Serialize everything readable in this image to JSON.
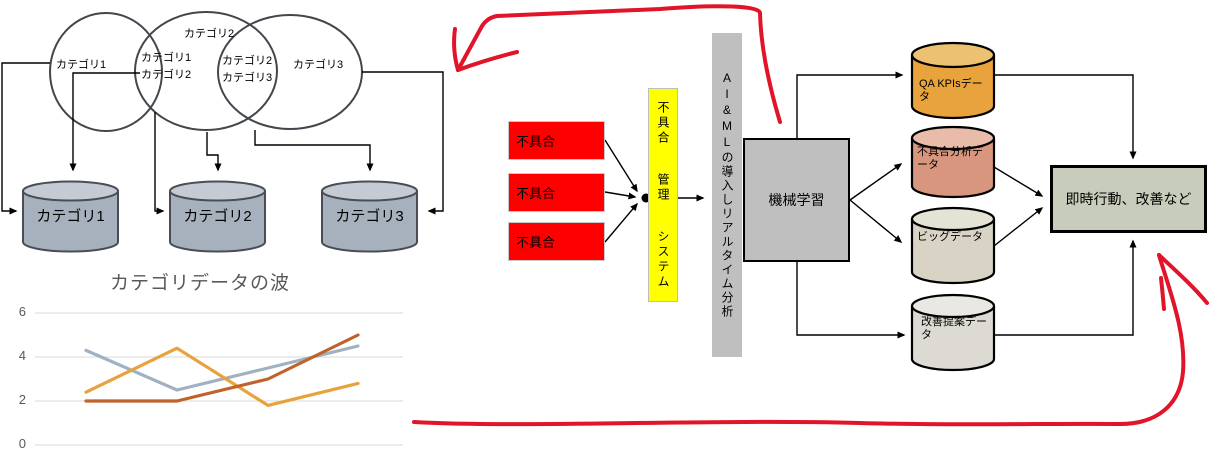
{
  "venn": {
    "label1": "カテゴリ1",
    "label2": "カテゴリ2",
    "label3": "カテゴリ3",
    "overlap12": [
      "カテゴリ1",
      "カテゴリ2"
    ],
    "overlap23": [
      "カテゴリ2",
      "カテゴリ3"
    ]
  },
  "databases": {
    "db1": "カテゴリ1",
    "db2": "カテゴリ2",
    "db3": "カテゴリ3"
  },
  "chart_data": {
    "type": "line",
    "title": "カテゴリデータの波",
    "categories": [
      1,
      2,
      3,
      4
    ],
    "series": [
      {
        "name": "gray",
        "color": "#A0B1C2",
        "values": [
          4.3,
          2.5,
          3.5,
          4.5
        ]
      },
      {
        "name": "gold",
        "color": "#E9A23B",
        "values": [
          2.4,
          4.4,
          1.8,
          2.8
        ]
      },
      {
        "name": "rust",
        "color": "#C0622C",
        "values": [
          2.0,
          2.0,
          3.0,
          5.0
        ]
      }
    ],
    "yticks": [
      0,
      2,
      4,
      6
    ],
    "ylim": [
      0,
      6
    ],
    "xlabel": "",
    "ylabel": "",
    "grid": true,
    "legend": "none"
  },
  "flow": {
    "defect_boxes": [
      "不具合",
      "不具合",
      "不具合"
    ],
    "defect_system": "不具合 管理 システム",
    "ai_bar": "AI&MLの導入しリアルタイム分析",
    "ml_box": "機械学習",
    "action_box": "即時行動、改善など",
    "cylinders": [
      {
        "label": "QA KPIsデータ"
      },
      {
        "label": "不具合分析データ"
      },
      {
        "label": "ビッグデータ"
      },
      {
        "label": "改善提案データ"
      }
    ]
  },
  "colors": {
    "defect_box": "#FF0000",
    "defect_system_bar": "#FFFF00",
    "ai_bar": "#BFBFBF",
    "ml_box": "#BFBFBF",
    "action_box": "#C8CCBA",
    "category_cylinder": "#A7B1BE",
    "qa_kpis_cylinder": "#E8A33C",
    "defect_analysis_cylinder": "#D9967E",
    "big_data_cylinder": "#D8D3C4",
    "improvement_cylinder": "#DCDAD2",
    "annotation_red": "#E1142A",
    "gridline": "#D9D9D9"
  }
}
